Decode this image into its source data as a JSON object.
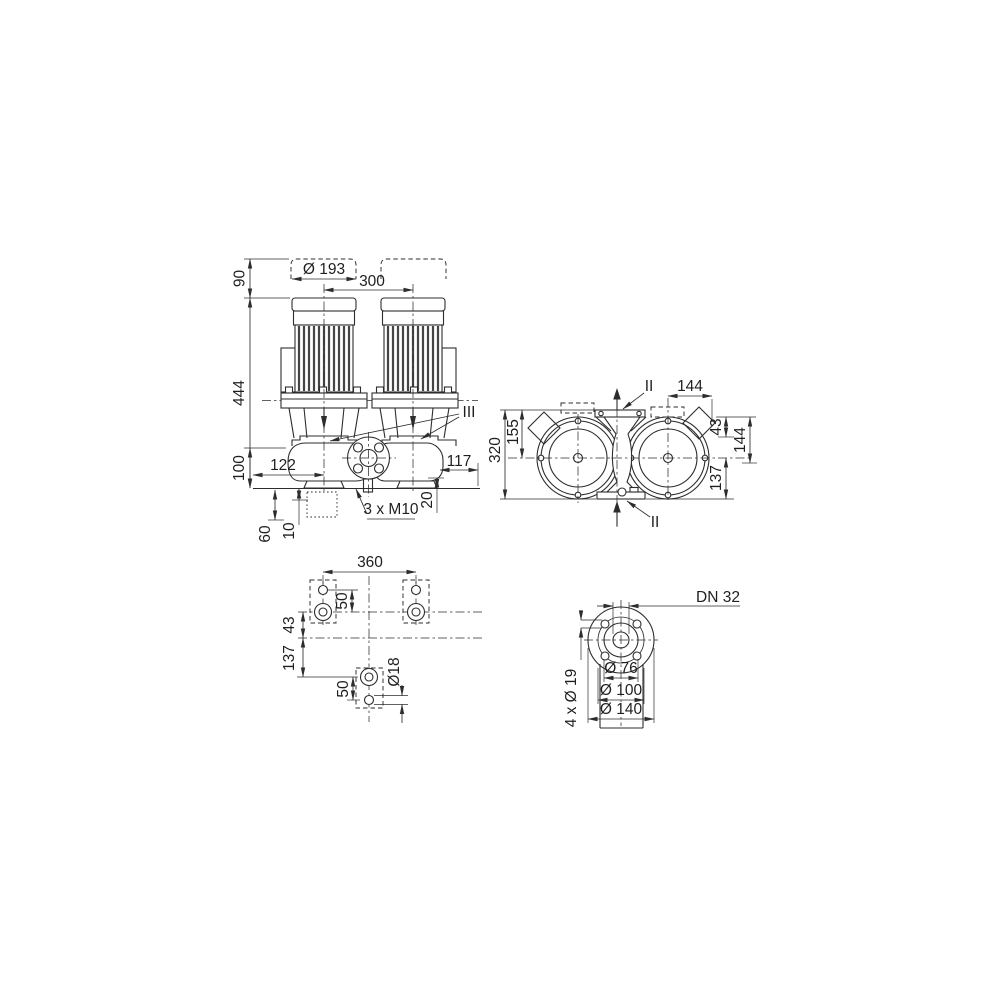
{
  "colors": {
    "line": "#2d2d2d",
    "text": "#1f1f1f",
    "background": "#ffffff"
  },
  "views": {
    "front": {
      "dims": {
        "motor_clearance": "90",
        "motor_diameter": "Ø 193",
        "motor_spacing": "300",
        "total_height": "444",
        "port_height": "100",
        "left_offset": "122",
        "right_offset": "117",
        "foundation_depth": "60",
        "grout": "10",
        "base_step": "20",
        "tapped_holes": "3 x M10",
        "section_iii": "III"
      }
    },
    "plan": {
      "dims": {
        "overall_depth": "320",
        "front_to_axis": "155",
        "axis_to_right": "144",
        "port_offset": "43",
        "flange_width": "144",
        "axis_to_rear": "137",
        "section_ii_top": "II",
        "section_ii_bottom": "II"
      }
    },
    "foundation": {
      "dims": {
        "bolt_spacing": "360",
        "slot_length_top": "50",
        "axis_offset": "43",
        "rear_offset": "137",
        "slot_length_bottom": "50",
        "hole_diameter": "Ø18"
      }
    },
    "flange": {
      "dims": {
        "nominal": "DN 32",
        "pilot": "Ø 76",
        "bolt_circle": "Ø 100",
        "outer": "Ø 140",
        "bolt_holes": "4 x Ø 19"
      }
    }
  }
}
